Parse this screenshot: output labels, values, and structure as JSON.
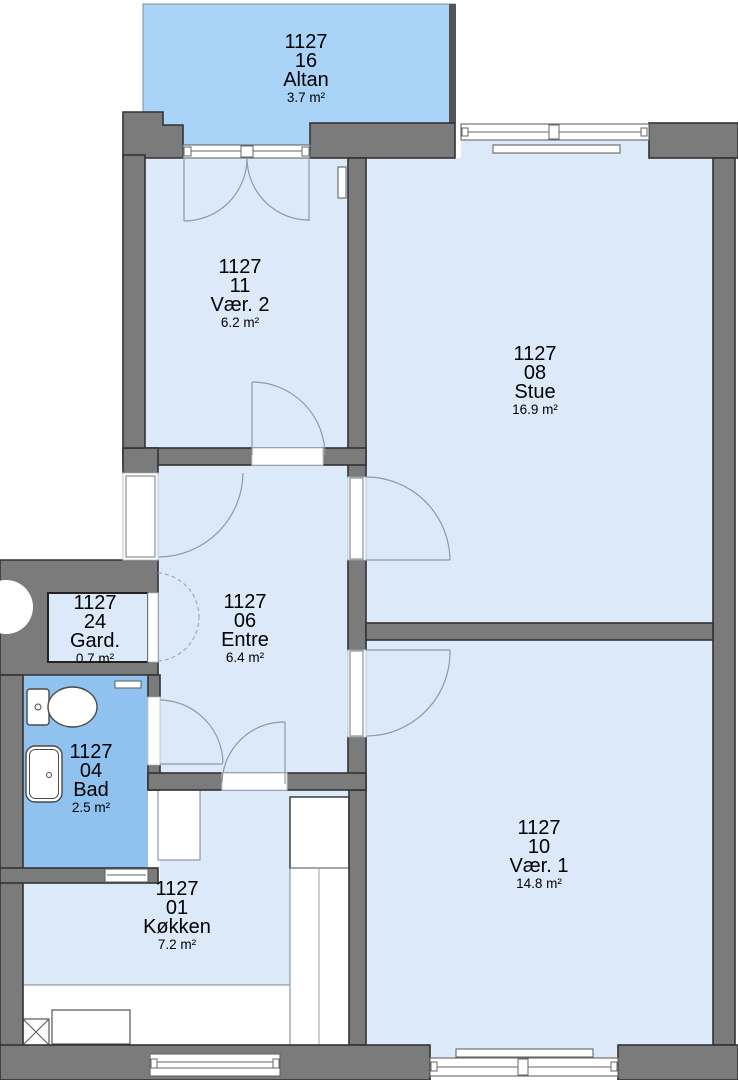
{
  "plan_title": "Apartment floor plan 1127",
  "rooms": [
    {
      "key": "altan",
      "building": "1127",
      "no": "16",
      "name": "Altan",
      "area": "3.7 m²"
    },
    {
      "key": "vaer2",
      "building": "1127",
      "no": "11",
      "name": "Vær. 2",
      "area": "6.2 m²"
    },
    {
      "key": "stue",
      "building": "1127",
      "no": "08",
      "name": "Stue",
      "area": "16.9 m²"
    },
    {
      "key": "gard",
      "building": "1127",
      "no": "24",
      "name": "Gard.",
      "area": "0.7 m²"
    },
    {
      "key": "entre",
      "building": "1127",
      "no": "06",
      "name": "Entre",
      "area": "6.4 m²"
    },
    {
      "key": "bad",
      "building": "1127",
      "no": "04",
      "name": "Bad",
      "area": "2.5 m²"
    },
    {
      "key": "koekken",
      "building": "1127",
      "no": "01",
      "name": "Køkken",
      "area": "7.2 m²"
    },
    {
      "key": "vaer1",
      "building": "1127",
      "no": "10",
      "name": "Vær. 1",
      "area": "14.8 m²"
    }
  ],
  "colors": {
    "wall": "#7b7b7b",
    "wall_outline": "#333333",
    "room_fill": "#dbe9f8",
    "balcony_fill": "#a9d4f7",
    "bath_fill": "#8fc2ee",
    "window_line": "#666666",
    "arc_line": "#8f99a4",
    "text": "#000000"
  }
}
